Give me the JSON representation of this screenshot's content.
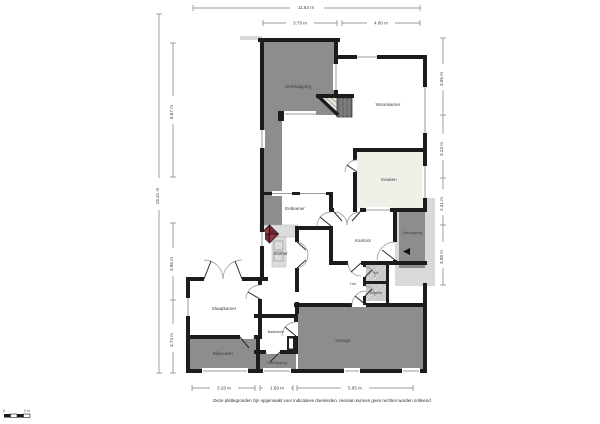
{
  "document": {
    "type": "floorplan",
    "language": "nl",
    "disclaimer": "Deze plattegronden zijn opgemaakt voor indicatieve doeleinden. Hieraan kunnen geen rechten worden ontleend"
  },
  "rooms": {
    "overkapping_nw": "Overkapping",
    "woonkamer": "Woonkamer",
    "keuken": "Keuken",
    "eetkamer": "Eetkamer",
    "kamer": "Kamer",
    "kantoor": "Kantoor",
    "overkapping_oost": "Overkapping",
    "hal": "Hal",
    "wc": "Wc",
    "douche": "Douche",
    "slaapkamer": "Slaapkamer",
    "badkamer": "Badkamer",
    "bijkeuken": "Bijkeuken",
    "overkapping_zuid": "Overkapping",
    "garage": "Garage"
  },
  "dimensions": {
    "top_total": "11.64 m",
    "top_left": "3.79 m",
    "top_right": "4.00 m",
    "left_total": "18.41 m",
    "left_upper": "6.87 m",
    "left_mid": "3.95 m",
    "left_lower": "3.74 m",
    "right_1": "3.95 m",
    "right_2": "3.23 m",
    "right_3": "2.41 m",
    "right_4": "3.08 m",
    "bottom_left": "3.28 m",
    "bottom_mid": "1.69 m",
    "bottom_right": "5.95 m"
  },
  "scalebar": {
    "start": "0",
    "end": "2 m"
  },
  "colors": {
    "wall": "#1c1c1c",
    "covered_area": "#8d8d8d",
    "outdoor_paving": "#d9d9d9",
    "tiled_room": "#f0efe8",
    "hatched_room": "#c9c9c9",
    "stove_red": "#8c3b41",
    "background": "#ffffff"
  }
}
